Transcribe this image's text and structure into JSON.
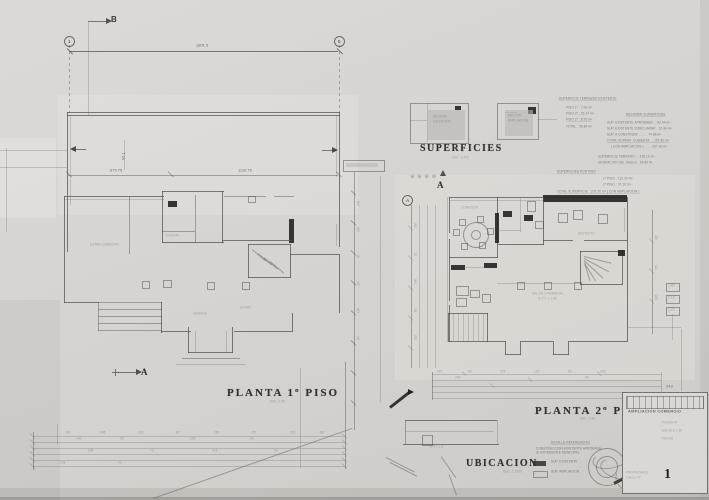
{
  "sheet": {
    "paper": "#d6d4d0",
    "ink": "#4a4846",
    "faint": "#8e8c88",
    "black": "#1f1e1c"
  },
  "top_markers": {
    "section_b": "B",
    "grid_left": "1",
    "grid_right": "5",
    "overall_dim": "1801.5"
  },
  "plan1": {
    "title": "PLANTA 1º PISO",
    "scale": "ESC. 1:50",
    "dim_left": "679.75",
    "dim_right": "1116.75",
    "dim_vert": "96.1",
    "section_a": "A",
    "label_kitchen": "COCINA",
    "label_left": "ESTAR COMEDOR",
    "label_center": "GARAGE",
    "label_right": "ESTAR"
  },
  "plan2": {
    "title": "PLANTA 2º PISO",
    "scale": "ESC. 1:50",
    "grid_bubble": "A",
    "section_a": "A",
    "symbols": "⊕ ⊕ ⊕ ⊗",
    "label_left_room": "COMEDOR",
    "label_right_room": "DEPOSITO",
    "label_main_1": "SALON COMERCIAL",
    "label_main_2": "N.P.T. + 2.80"
  },
  "superficies": {
    "title": "SUPERFICIES",
    "scale": "ESC. 1:200",
    "mini1_label_1": "SECTOR",
    "mini1_label_2": "EXISTENTE",
    "mini2_label_1": "SECTOR",
    "mini2_label_2": "AMPLIACION",
    "block": {
      "s1_title": "SUPERFICIE TERRAZAS EXISTENTE",
      "s1": [
        "PISO 1º :   7.00 m²",
        "PISO 2º :  15.14 m²",
        "PISO 2º :   8.70 m²",
        "TOTAL   :  30.84 m²"
      ],
      "resumen_title": "RESUMEN SUPERFICIES",
      "resumen": [
        "SUP. EXISTENTE APROBADA . . 82.44 m²",
        "SUP. EXISTENTE S/DECLARAR . 12.40 m²",
        "SUP. A CONSTRUIR  . . . . . 74.86 m²",
        "TOTAL SUPERF. CUBIERTA . . 157.30 m²",
        "( CON AMPLIACION ) . . . . 207.30 m²"
      ],
      "terreno": [
        "SUPERFICIE TERRENO . .  278.10 m²",
        "OCUPACION DEL SUELO  .   54.80 %"
      ],
      "porpiso_title": "SUPERFICIES POR PISO",
      "porpiso": [
        "1º PISO : 110.20 m²",
        "2º PISO :  97.10 m²"
      ],
      "total": "TOTAL SUPERFICIE :  207.30 m²  ( CON AMPLIACION )"
    }
  },
  "ubicacion": {
    "title": "UBICACION",
    "scale": "ESC. 1:1000",
    "street": "C A L L E"
  },
  "legend": {
    "title": "DETALLE REFERENCIAS",
    "note_1": "CONSTRUCCION EXISTENTE APROBADA",
    "note_2": "S/ EXPEDIENTE MUNICIPAL",
    "filled_label": "SUP. EXISTENTE",
    "open_label": "SUP. AMPLIACION"
  },
  "titleblock": {
    "ref_no": "243",
    "project": "AMPLIACION COMERCIO",
    "row_1": "PLANO Nº",
    "row_2": "ESCALA 1:50",
    "row_3": "FECHA",
    "note_1": "PROPIETARIO",
    "note_2": "CALLE  Nº",
    "sheet_no": "1"
  },
  "dim_numbers": {
    "mid_col": [
      "245",
      "120",
      "85",
      "310",
      "150",
      "95"
    ],
    "plan2_left": [
      "260",
      "95",
      "140",
      "80",
      "210"
    ],
    "plan2_right": [
      "415",
      "270",
      "185"
    ],
    "plan2_bottom": [
      "407",
      "80",
      "275",
      "125",
      "60",
      "315",
      "240",
      "95"
    ],
    "bottom_rows": [
      "98",
      "345",
      "120",
      "67",
      "250",
      "75",
      "110",
      "88",
      "140",
      "95",
      "230",
      "60",
      "185",
      "72",
      "315",
      "55",
      "128",
      "93"
    ],
    "boxes": [
      "2.80",
      "0.15",
      "1.20"
    ]
  }
}
